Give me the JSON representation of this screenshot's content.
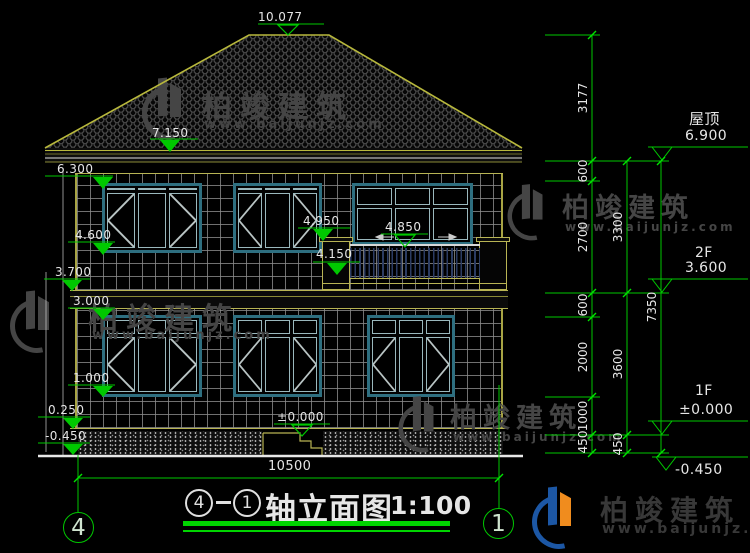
{
  "drawing_title": {
    "axis_start": "4",
    "separator": "—",
    "axis_end": "1",
    "name": "轴立面图",
    "scale": "1:100"
  },
  "axis_bubbles": {
    "left": "4",
    "right": "1"
  },
  "bottom_dimension": {
    "overall_width": "10500"
  },
  "markers_left": [
    {
      "value": "10.077"
    },
    {
      "value": "7.150"
    },
    {
      "value": "6.300"
    },
    {
      "value": "4.600"
    },
    {
      "value": "3.700"
    },
    {
      "value": "3.000"
    },
    {
      "value": "1.000"
    },
    {
      "value": "0.250"
    },
    {
      "value": "-0.450"
    },
    {
      "value": "±0.000"
    },
    {
      "value": "4.950"
    },
    {
      "value": "4.850"
    },
    {
      "value": "4.150"
    }
  ],
  "markers_right": [
    {
      "label": "屋顶",
      "value": "6.900"
    },
    {
      "label": "2F",
      "value": "3.600"
    },
    {
      "label": "1F",
      "value": "±0.000"
    },
    {
      "label": "",
      "value": "-0.450"
    }
  ],
  "dim_chains": {
    "inner": [
      "3177",
      "600",
      "2700",
      "600",
      "2000",
      "1000",
      "450"
    ],
    "middle": [
      "3300",
      "3600",
      "450"
    ],
    "outer": [
      "7350"
    ]
  },
  "watermark": {
    "brand": "柏竣建筑",
    "url": "www.baijunjz.com"
  },
  "footer_logo": {
    "brand": "柏竣建筑",
    "url": "www.baijunjz.com"
  },
  "colors": {
    "dimension_green": "#00c800",
    "cad_yellow": "#b8b454",
    "window_teal": "#2e6f80",
    "text_white": "#e6e6e6",
    "watermark_gray": "#454545",
    "logo_blue": "#1c57a5",
    "logo_orange": "#f08c1e"
  }
}
